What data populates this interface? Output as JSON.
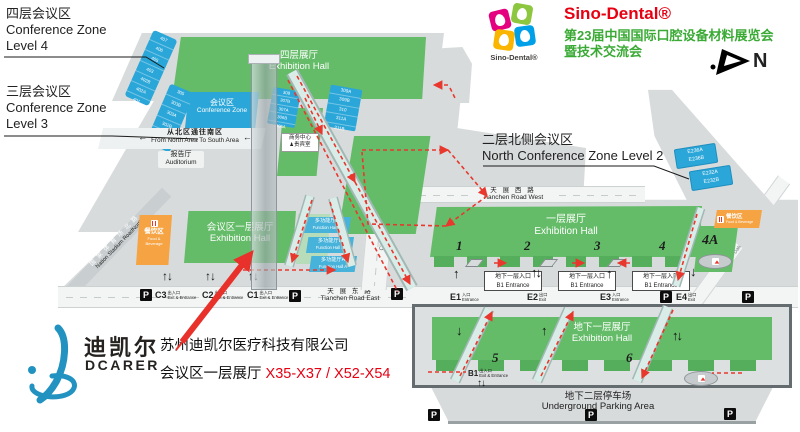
{
  "brand": {
    "logo_caption": "Sino-Dental®",
    "title": "Sino-Dental®",
    "sub1": "第23届中国国际口腔设备材料展览会",
    "sub2": "暨技术交流会"
  },
  "compass": {
    "label": "N"
  },
  "titles": {
    "l4_cn": "四层会议区",
    "l4_en1": "Conference Zone",
    "l4_en2": "Level 4",
    "l3_cn": "三层会议区",
    "l3_en1": "Conference Zone",
    "l3_en2": "Level 3",
    "l2_cn": "二层北侧会议区",
    "l2_en": "North Conference Zone Level 2"
  },
  "level4": {
    "rooms": [
      "407",
      "406",
      "405",
      "403",
      "402B",
      "402A",
      "401"
    ],
    "hall_cn": "四层展厅",
    "hall_en": "Exhibition Hall"
  },
  "level3": {
    "rooms_left": [
      "305",
      "303B",
      "303A",
      "302B",
      "302A",
      "301A"
    ],
    "zone_cn": "会议区",
    "zone_en": "Conference Zone",
    "corridor_cn": "从北区通往南区",
    "corridor_en": "From North Area To South Area",
    "auditorium_cn": "报告厅",
    "auditorium_en": "Auditorium",
    "rooms_mid": [
      "308",
      "307B",
      "307A",
      "306B",
      "306A"
    ],
    "rooms_right": [
      "309A",
      "309B",
      "310",
      "311A",
      "311B"
    ],
    "business_cn": "商务中心",
    "vip_cn": "贵宾室"
  },
  "level2": {
    "e236a": "E236A",
    "e236b": "E236B",
    "e232a": "E232A",
    "e232b": "E232B"
  },
  "roads": {
    "west_cn": "天 展 西 路",
    "west_en": "Tianchen Road West",
    "east_cn": "天 展 东 路",
    "east_en": "Tianchen Road East",
    "city_cn": "规划道路",
    "city_en": "City Road",
    "stadium_cn": "国家体育场北路",
    "stadium_en": "Nation Stadium RoadNorth",
    "datun_cn": "大屯路",
    "datun_en": "Datun Road"
  },
  "hall_north": {
    "name_cn": "一层展厅",
    "name_en": "Exhibition Hall",
    "s1": "1",
    "s2": "2",
    "s3": "3",
    "s4": "4",
    "s4a": "4A",
    "b1_cn": "地下一层入口",
    "b1_en": "B1 Entrance",
    "e1": "E1",
    "e1_cn": "入口",
    "e1_en": "Entrance",
    "e2": "E2",
    "e2_cn": "出口",
    "e2_en": "Exit",
    "e3": "E3",
    "e3_cn": "入口",
    "e3_en": "Entrance",
    "e4": "E4",
    "e4_cn": "出口",
    "e4_en": "Exit"
  },
  "hall_south": {
    "name_cn": "会议区一层展厅",
    "name_en": "Exhibition Hall",
    "fh_c_cn": "多功能厅C",
    "fh_c_en": "Function Hall C",
    "fh_b_cn": "多功能厅B",
    "fh_b_en": "Function Hall B",
    "fh_a_cn": "多功能厅A",
    "fh_a_en": "Function Hall A",
    "c3": "C3",
    "c2": "C2",
    "c1": "C1",
    "c_cn": "出入口",
    "c_en": "Exit & Entrance"
  },
  "food": {
    "cn": "餐饮区",
    "en": "Food & Beverage",
    "en1": "Food &",
    "en2": "Beverage"
  },
  "b1": {
    "name_cn": "地下一层展厅",
    "name_en": "Exhibition Hall",
    "s5": "5",
    "s6": "6",
    "gate": "B1",
    "gate_cn": "出入口",
    "gate_en": "Exit & Entrance"
  },
  "parking": {
    "cn": "地下二层停车场",
    "en": "Underground Parking Area"
  },
  "icons": {
    "parking": "P",
    "arrow_left": "←",
    "arrow_up": "↑",
    "arrow_down": "↓",
    "arrow_updown": "↑↓",
    "vip_person": "♟"
  },
  "dcarer": {
    "cn": "迪凯尔",
    "en": "DCARER",
    "company": "苏州迪凯尔医疗科技有限公司",
    "booth_label": "会议区一层展厅 ",
    "booth_red": "X35-X37 / X52-X54"
  },
  "colors": {
    "green": "#64bc68",
    "blue": "#2ba6d8",
    "orange": "#f5a343",
    "red": "#e8382d",
    "brand_red": "#e60012",
    "brand_green": "#3aaa35",
    "dcarer_blue": "#2293c0"
  }
}
